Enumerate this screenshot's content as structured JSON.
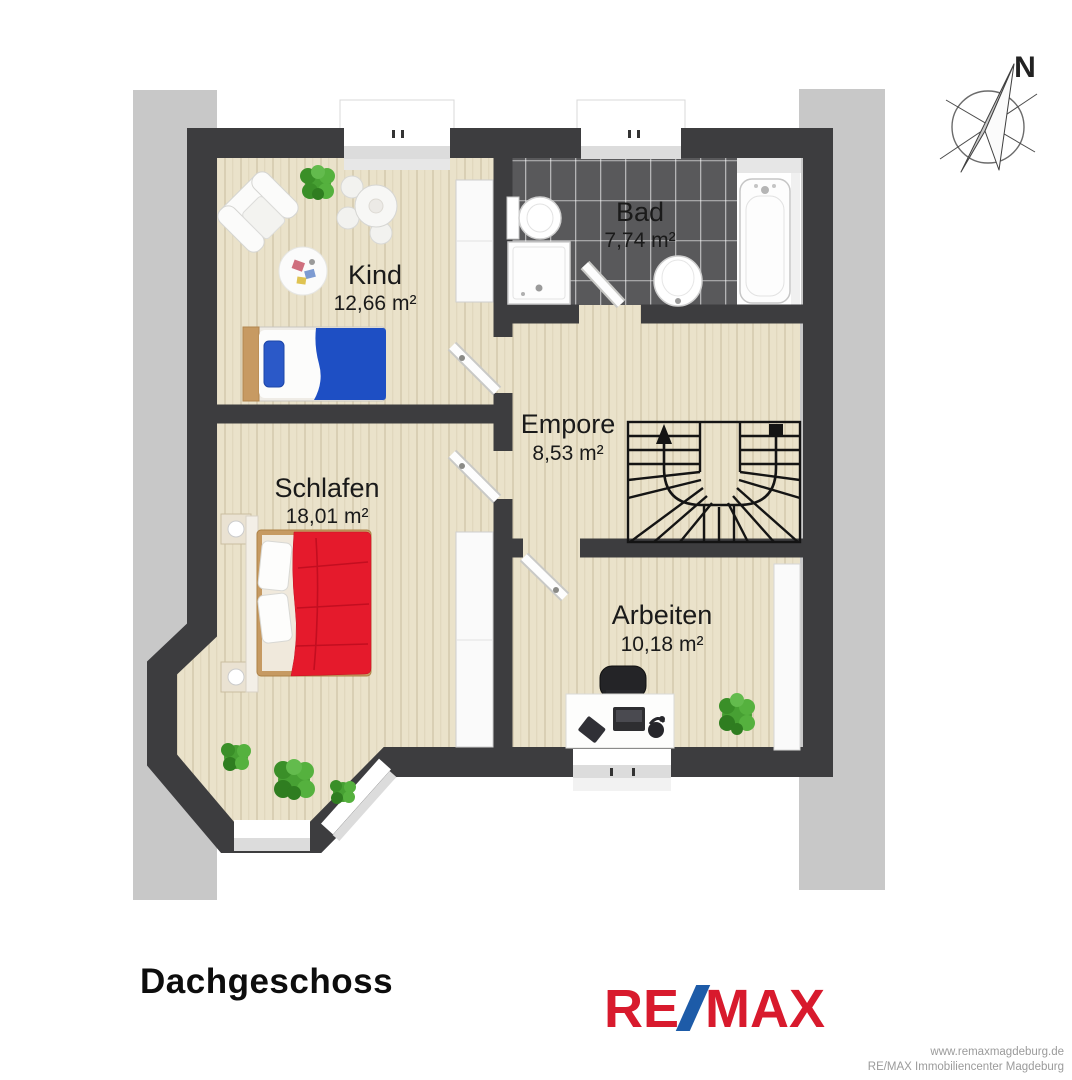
{
  "title": "Dachgeschoss",
  "compass": {
    "label": "N"
  },
  "rooms": {
    "kind": {
      "name": "Kind",
      "area": "12,66 m²"
    },
    "bad": {
      "name": "Bad",
      "area": "7,74 m²"
    },
    "empore": {
      "name": "Empore",
      "area": "8,53 m²"
    },
    "schlafen": {
      "name": "Schlafen",
      "area": "18,01 m²"
    },
    "arbeiten": {
      "name": "Arbeiten",
      "area": "10,18 m²"
    }
  },
  "logo": {
    "re": "RE",
    "slash": "/",
    "max": "MAX"
  },
  "footer": {
    "line1": "www.remaxmagdeburg.de",
    "line2": "RE/MAX Immobiliencenter Magdeburg"
  },
  "colors": {
    "wall": "#3d3d3f",
    "roof_band": "#c8c8c8",
    "wood_floor": "#eae2ca",
    "tile_floor": "#59595b",
    "remax_red": "#d81a2d",
    "remax_blue": "#1d5ba8",
    "bed_red": "#e51a2c",
    "bed_blue": "#1e4fc4",
    "plant_green": "#47a033"
  }
}
